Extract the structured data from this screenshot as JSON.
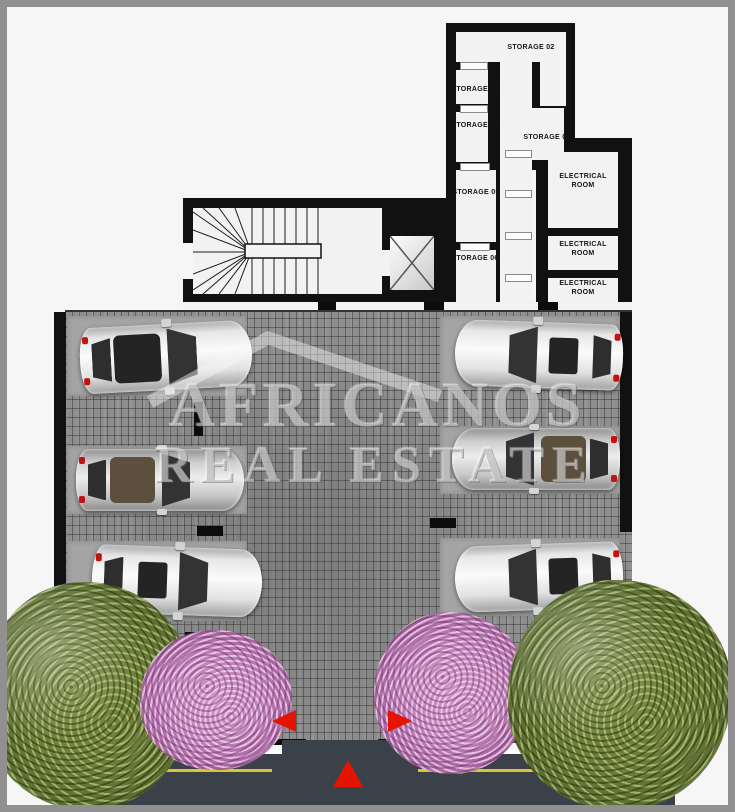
{
  "document": {
    "kind": "architectural floor plan",
    "view": "parking level with storage and electrical rooms"
  },
  "rooms": {
    "storage01": {
      "label": "STORAGE 01"
    },
    "storage02": {
      "label": "STORAGE 02"
    },
    "storage03": {
      "label": "STORAGE 03"
    },
    "storage04": {
      "label": "STORAGE 04"
    },
    "storage05": {
      "label": "STORAGE 05"
    },
    "storage06": {
      "label": "STORAGE 06"
    },
    "electrical1": {
      "label": "ELECTRICAL ROOM"
    },
    "electrical2": {
      "label": "ELECTRICAL ROOM"
    },
    "electrical3": {
      "label": "ELECTRICAL ROOM"
    }
  },
  "watermark": {
    "line1": "AFRICANOS",
    "line2": "REAL ESTATE"
  },
  "features": {
    "parking_spaces": 6,
    "cars": [
      {
        "name": "car-left-top",
        "body": "white",
        "facing": "right"
      },
      {
        "name": "car-left-middle",
        "body": "silver",
        "facing": "right"
      },
      {
        "name": "car-left-bottom",
        "body": "white",
        "facing": "right"
      },
      {
        "name": "car-right-top",
        "body": "white",
        "facing": "left"
      },
      {
        "name": "car-right-middle",
        "body": "silver",
        "facing": "left"
      },
      {
        "name": "car-right-bottom",
        "body": "white",
        "facing": "left"
      }
    ],
    "trees": [
      {
        "name": "green-tree-left",
        "color": "green"
      },
      {
        "name": "pink-tree-left",
        "color": "pink"
      },
      {
        "name": "pink-tree-right",
        "color": "pink"
      },
      {
        "name": "green-tree-right",
        "color": "green"
      }
    ],
    "icons": [
      {
        "name": "drive-arrow-left-icon",
        "glyph": "triangle-left"
      },
      {
        "name": "drive-arrow-right-icon",
        "glyph": "triangle-right"
      },
      {
        "name": "entrance-arrow-up-icon",
        "glyph": "triangle-up"
      }
    ]
  },
  "colors": {
    "arrow_red": "#e51400",
    "road_asphalt": "#3a4149",
    "lane_yellow": "#d8c531",
    "paving_gray": "#8e8e8e",
    "wall_black": "#111111",
    "room_fill": "#f2f2f2",
    "frame_border": "#909090",
    "canvas_bg": "#f6f6f6",
    "tree_green": "#6f7f3a",
    "tree_pink": "#c383bd"
  }
}
